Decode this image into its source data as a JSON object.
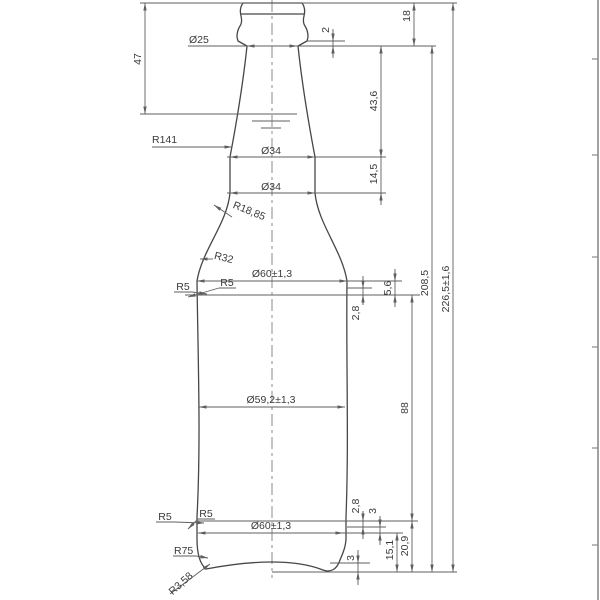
{
  "colors": {
    "background": "#ffffff",
    "outline_line": "#474747",
    "dimension_line": "#5f5f5f",
    "text": "#3a3a3a",
    "frame_border": "#8a8a8a"
  },
  "labels": {
    "dia25": "Ø25",
    "dim2": "2",
    "dim18": "18",
    "dim47": "47",
    "dim43_6": "43,6",
    "r141": "R141",
    "dia34a": "Ø34",
    "dim14_5": "14,5",
    "dia34b": "Ø34",
    "r18_85": "R18,85",
    "r32": "R32",
    "dia60t": "Ø60±1,3",
    "r5t1": "R5",
    "r5t2": "R5",
    "dim5_6": "5,6",
    "dim2_8t": "2,8",
    "dim208_5": "208,5",
    "dim226_5": "226,5±1,6",
    "dia59_2": "Ø59,2±1,3",
    "dim88": "88",
    "dim20_9": "20,9",
    "dim15_1": "15,1",
    "dim2_8b": "2,8",
    "dim3b": "3",
    "dia60b": "Ø60±1,3",
    "r5b1": "R5",
    "r5b2": "R5",
    "r75": "R75",
    "r3_58": "R3,58",
    "dim3base": "3"
  },
  "dimensions": {
    "overall_height": "226,5±1,6",
    "height_to_finish_base": "208,5",
    "fill_level_from_top": "47",
    "finish_height": "18",
    "bead_height": "2",
    "neck_taper_length": "43,6",
    "neck_straight_length": "14,5",
    "shoulder_transition": [
      "5,6",
      "2,8"
    ],
    "body_label_panel": "88",
    "base_transition": [
      "2,8",
      "3",
      "15,1",
      "20,9"
    ],
    "punt_depth": "3",
    "diameters": {
      "finish": "Ø25",
      "neck_upper": "Ø34",
      "neck_lower": "Ø34",
      "body_top": "Ø60±1,3",
      "body_waist": "Ø59,2±1,3",
      "body_bottom": "Ø60±1,3"
    },
    "radii": {
      "neck": "R141",
      "shoulder_upper": "R18,85",
      "shoulder_lower": "R32",
      "body_top_corners": [
        "R5",
        "R5"
      ],
      "body_bottom_corners": [
        "R5",
        "R5"
      ],
      "base": "R75",
      "heel": "R3,58"
    }
  }
}
